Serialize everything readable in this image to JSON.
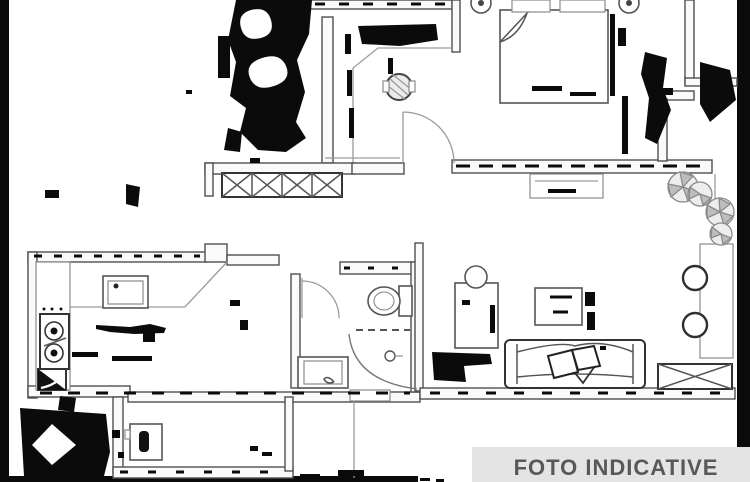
{
  "banner": {
    "label": "FOTO INDICATIVE",
    "bg": "#e4e4e4",
    "text_color": "#57585a"
  },
  "image": {
    "kind": "apartment floor plan, degraded black-and-white scan",
    "background": "#ffffff",
    "line_color": "#4f4f4f",
    "artifact_color": "#0b0b0b",
    "symbols": [
      "double-bed",
      "pillows",
      "bedside-lamps",
      "hall-stool",
      "entry-door-arc",
      "radiator-x-box",
      "window-box",
      "kitchen-counter",
      "stove-burners",
      "kitchen-sink",
      "corner-cabinet",
      "washing-machine",
      "toilet",
      "bathroom-sink",
      "shower-curve",
      "sofa",
      "sofa-pillows",
      "coffee-table",
      "desk-and-stool",
      "terrace-plants",
      "terrace-table",
      "deco-circles",
      "x-doormat"
    ]
  }
}
